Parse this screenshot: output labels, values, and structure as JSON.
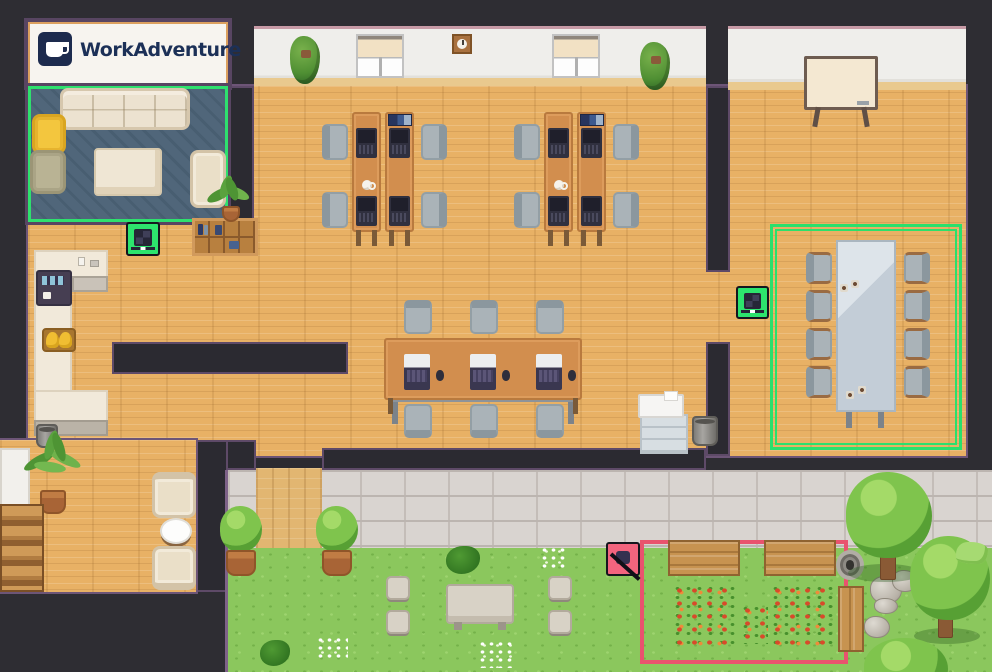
{
  "app": {
    "name": "WorkAdventure",
    "view": "virtual-office-map"
  },
  "sign": {
    "logo_text": "WorkAdventure",
    "logo_icon": "coffee-mug-icon"
  },
  "zones": [
    {
      "id": "lounge",
      "label": "lounge meeting area",
      "marker": "green-border",
      "color": "#2de46d"
    },
    {
      "id": "meeting-room",
      "label": "meeting room area",
      "marker": "green-double-border",
      "color": "#2de46d"
    },
    {
      "id": "garden",
      "label": "quiet garden area",
      "marker": "red-border",
      "color": "#e9536e",
      "icon": "muted-icon"
    },
    {
      "id": "meet-tile-west",
      "label": "laptop meeting tile",
      "icon": "laptop-icon",
      "color": "#2de46d"
    },
    {
      "id": "meet-tile-east",
      "label": "laptop meeting tile",
      "icon": "laptop-icon",
      "color": "#2de46d"
    }
  ],
  "areas": {
    "lounge": {
      "items": [
        "sofa",
        "yellow armchair",
        "olive armchair",
        "coffee table",
        "cream armchair",
        "striped rug"
      ]
    },
    "office": {
      "desk_pods": 2,
      "desks": 4,
      "desk_laptops": 8,
      "desk_chairs": 8,
      "shared_table": {
        "laptops": 3,
        "mice": 3,
        "chairs": 6
      },
      "decor": [
        "bookshelf",
        "potted palm",
        "hanging plant",
        "hanging plant",
        "window",
        "window",
        "wall clock",
        "coffee mugs",
        "book stacks"
      ]
    },
    "kitchen": {
      "items": [
        "counter",
        "coffee machine",
        "bananas",
        "trash bin",
        "counter items"
      ]
    },
    "meeting_room": {
      "table": 1,
      "chairs": 8,
      "coffee_cups": 4,
      "whiteboard": 1
    },
    "print_corner": {
      "items": [
        "printer",
        "drawer cabinet",
        "trash bin"
      ]
    },
    "reading_corner": {
      "items": [
        "armchair",
        "round side table",
        "armchair",
        "potted palm",
        "wooden stairs",
        "white cabinet"
      ]
    },
    "outdoor": {
      "items": [
        "wooden deck",
        "potted tree",
        "potted tree",
        "stone picnic table",
        "stone stool x4",
        "wooden bench x3",
        "flower bed x3",
        "stone well",
        "rock pile",
        "tree x3",
        "grass tufts",
        "white flowers",
        "bushes"
      ]
    }
  },
  "colors": {
    "wall": "#2e2d33",
    "wood_floor": "#e8b165",
    "white_wall": "#efeeeb",
    "rug": "#4e6477",
    "grass": "#8bc75d",
    "pavement": "#d9d4d2",
    "zone_green": "#2de46d",
    "zone_red": "#e9536e",
    "logo_navy": "#1d2b4e",
    "desk_wood": "#d28e4e"
  }
}
